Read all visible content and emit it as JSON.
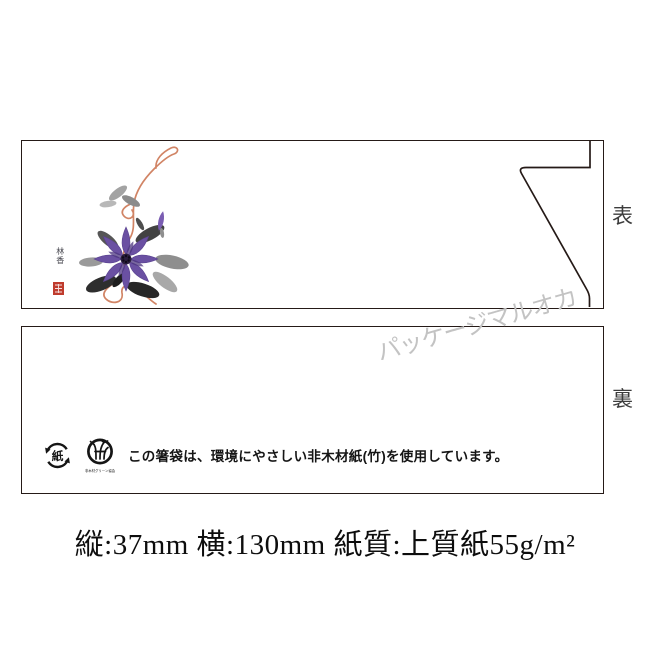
{
  "product": {
    "front": {
      "label": "表",
      "artwork": {
        "name": "clematis-ink-painting",
        "signature": "林香"
      }
    },
    "back": {
      "label": "裏",
      "eco_notice": "この箸袋は、環境にやさしい非木材紙(竹)を使用しています。",
      "icons": [
        {
          "name": "paper-recycle-mark",
          "glyph": "紙"
        },
        {
          "name": "non-wood-green-mark",
          "caption": "非木材グリーン協会"
        }
      ]
    },
    "watermark": "パッケージマルオカ",
    "spec_caption": "縦:37mm 横:130mm 紙質:上質紙55g/m²"
  },
  "colors": {
    "panel_border": "#251a17",
    "flower_purple": "#6a50a2",
    "flower_center": "#2a1d3d",
    "vine_orange": "#d18465",
    "seal_red": "#bf3b2d",
    "watermark_grey": "#c3c3c3"
  }
}
